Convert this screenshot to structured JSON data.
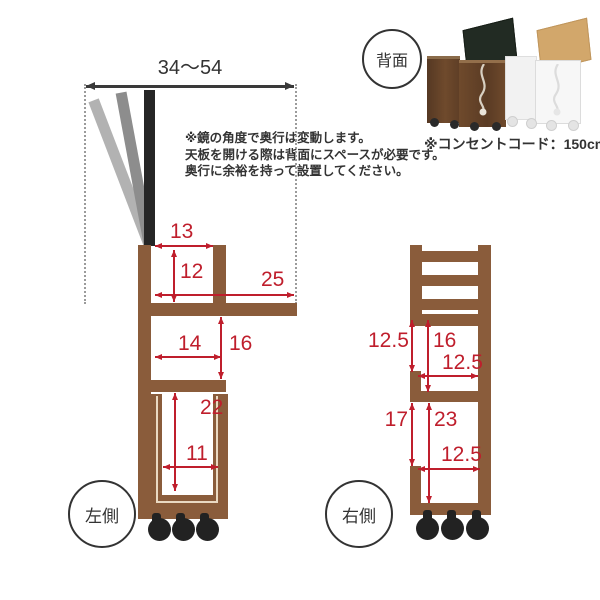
{
  "colors": {
    "wood": "#8a5c3b",
    "red": "#bf1e2c",
    "ink": "#333333",
    "mirror_black": "#262626",
    "mirror_gray_light": "#b2b2b2",
    "mirror_gray_dark": "#8d8d8d",
    "caster": "#222222",
    "drawer_stripe": "#ead9c2",
    "walnut_dark": "#5e3e26",
    "walnut": "#6f4a2c",
    "lid_dark": "#222b23",
    "white_cart": "#f4f4f4",
    "lid_oak": "#d2a76b"
  },
  "header": {
    "back_label": "背面",
    "cord_caption": "※コンセントコード：150cm"
  },
  "note": {
    "line1": "※鏡の角度で奥行は変動します。",
    "line2": "天板を開ける際は背面にスペースが必要です。",
    "line3": "奥行に余裕を持って設置してください。"
  },
  "left_view": {
    "label": "左側",
    "top_span": "34〜54",
    "dims": {
      "opening_width": "13",
      "opening_height": "12",
      "table_depth": "25",
      "mid_width": "14",
      "mid_height": "16",
      "lower_height": "22",
      "lower_width": "11"
    }
  },
  "right_view": {
    "label": "右側",
    "dims": {
      "upper_offset": "12.5",
      "upper_height": "16",
      "upper_width": "12.5",
      "side_opening": "17",
      "lower_height": "23",
      "lower_width": "12.5"
    }
  }
}
